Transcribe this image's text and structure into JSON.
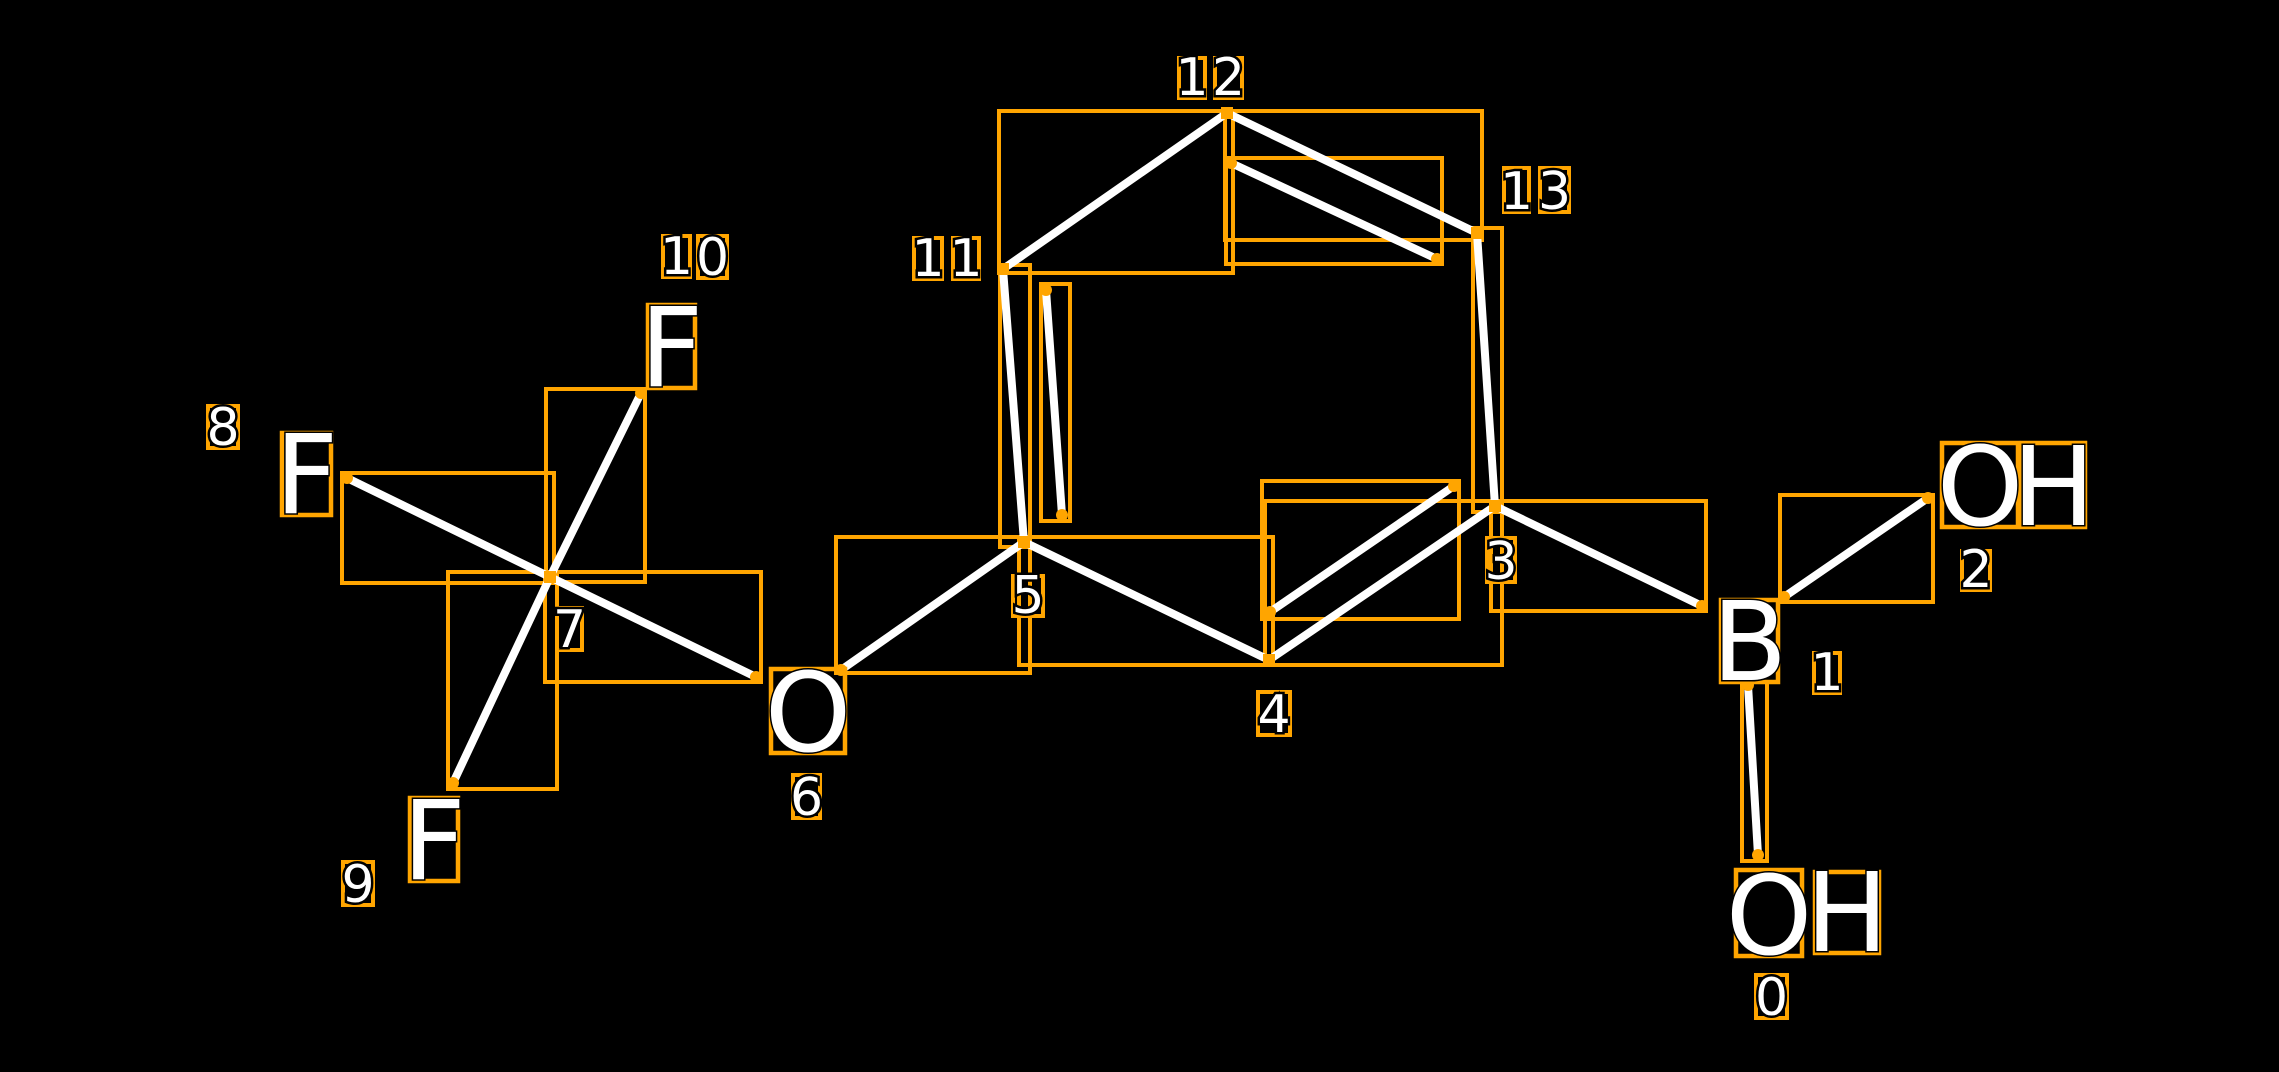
{
  "canvas": {
    "width": 2279,
    "height": 1072,
    "background": "#000000"
  },
  "colors": {
    "box_orange": "#FFA500",
    "bond_white": "#FFFFFF",
    "text_white": "#FFFFFF",
    "text_outline": "#000000"
  },
  "molecule": {
    "atoms": [
      {
        "index": 0,
        "symbol": "OH",
        "letters": [
          {
            "ch": "O",
            "x": 1736,
            "y": 870,
            "w": 66,
            "h": 86
          },
          {
            "ch": "H",
            "x": 1815,
            "y": 872,
            "w": 64,
            "h": 81
          }
        ]
      },
      {
        "index": 1,
        "symbol": "B",
        "letters": [
          {
            "ch": "B",
            "x": 1721,
            "y": 600,
            "w": 57,
            "h": 82
          }
        ]
      },
      {
        "index": 2,
        "symbol": "OH",
        "letters": [
          {
            "ch": "O",
            "x": 1942,
            "y": 443,
            "w": 76,
            "h": 84
          },
          {
            "ch": "H",
            "x": 2022,
            "y": 443,
            "w": 63,
            "h": 84
          }
        ]
      },
      {
        "index": 6,
        "symbol": "O",
        "letters": [
          {
            "ch": "O",
            "x": 771,
            "y": 669,
            "w": 74,
            "h": 84
          }
        ]
      },
      {
        "index": 8,
        "symbol": "F",
        "letters": [
          {
            "ch": "F",
            "x": 282,
            "y": 433,
            "w": 49,
            "h": 82
          }
        ]
      },
      {
        "index": 9,
        "symbol": "F",
        "letters": [
          {
            "ch": "F",
            "x": 410,
            "y": 798,
            "w": 48,
            "h": 83
          }
        ]
      },
      {
        "index": 10,
        "symbol": "F",
        "letters": [
          {
            "ch": "F",
            "x": 648,
            "y": 305,
            "w": 47,
            "h": 83
          }
        ]
      }
    ],
    "index_labels": [
      {
        "text": "0",
        "digits": [
          {
            "ch": "0",
            "x": 1756,
            "y": 975,
            "w": 31,
            "h": 43
          }
        ]
      },
      {
        "text": "1",
        "digits": [
          {
            "ch": "1",
            "x": 1814,
            "y": 653,
            "w": 26,
            "h": 40
          }
        ]
      },
      {
        "text": "2",
        "digits": [
          {
            "ch": "2",
            "x": 1962,
            "y": 551,
            "w": 28,
            "h": 39
          }
        ]
      },
      {
        "text": "3",
        "digits": [
          {
            "ch": "3",
            "x": 1487,
            "y": 538,
            "w": 28,
            "h": 44
          }
        ]
      },
      {
        "text": "4",
        "digits": [
          {
            "ch": "4",
            "x": 1258,
            "y": 692,
            "w": 32,
            "h": 43
          }
        ]
      },
      {
        "text": "5",
        "digits": [
          {
            "ch": "5",
            "x": 1013,
            "y": 576,
            "w": 30,
            "h": 40
          }
        ]
      },
      {
        "text": "6",
        "digits": [
          {
            "ch": "6",
            "x": 793,
            "y": 775,
            "w": 27,
            "h": 43
          }
        ]
      },
      {
        "text": "7",
        "digits": [
          {
            "ch": "7",
            "x": 557,
            "y": 608,
            "w": 25,
            "h": 42
          }
        ]
      },
      {
        "text": "8",
        "digits": [
          {
            "ch": "8",
            "x": 208,
            "y": 406,
            "w": 30,
            "h": 42
          }
        ]
      },
      {
        "text": "9",
        "digits": [
          {
            "ch": "9",
            "x": 343,
            "y": 862,
            "w": 30,
            "h": 43
          }
        ]
      },
      {
        "text": "10",
        "digits": [
          {
            "ch": "1",
            "x": 663,
            "y": 236,
            "w": 27,
            "h": 41
          },
          {
            "ch": "0",
            "x": 698,
            "y": 236,
            "w": 29,
            "h": 42
          }
        ]
      },
      {
        "text": "11",
        "digits": [
          {
            "ch": "1",
            "x": 914,
            "y": 238,
            "w": 28,
            "h": 41
          },
          {
            "ch": "1",
            "x": 953,
            "y": 238,
            "w": 26,
            "h": 41
          }
        ]
      },
      {
        "text": "12",
        "digits": [
          {
            "ch": "1",
            "x": 1179,
            "y": 58,
            "w": 26,
            "h": 40
          },
          {
            "ch": "2",
            "x": 1215,
            "y": 58,
            "w": 27,
            "h": 40
          }
        ]
      },
      {
        "text": "13",
        "digits": [
          {
            "ch": "1",
            "x": 1504,
            "y": 168,
            "w": 25,
            "h": 44
          },
          {
            "ch": "3",
            "x": 1540,
            "y": 168,
            "w": 29,
            "h": 44
          }
        ]
      }
    ],
    "bonds": [
      {
        "name": "C11-C12",
        "x1": 1003,
        "y1": 269,
        "x2": 1227,
        "y2": 113,
        "box": [
          999,
          111,
          234,
          162
        ]
      },
      {
        "name": "C12-C13",
        "x1": 1227,
        "y1": 113,
        "x2": 1477,
        "y2": 233,
        "box": [
          1225,
          111,
          257,
          129
        ]
      },
      {
        "name": "C12-C13-inner",
        "x1": 1231,
        "y1": 163,
        "x2": 1437,
        "y2": 259,
        "box": [
          1226,
          158,
          216,
          106
        ]
      },
      {
        "name": "C13-C3",
        "x1": 1477,
        "y1": 233,
        "x2": 1495,
        "y2": 506,
        "box": [
          1473,
          228,
          29,
          284
        ]
      },
      {
        "name": "C3-C4",
        "x1": 1495,
        "y1": 506,
        "x2": 1269,
        "y2": 660,
        "box": [
          1265,
          501,
          237,
          164
        ]
      },
      {
        "name": "C3-C4-inner",
        "x1": 1454,
        "y1": 486,
        "x2": 1270,
        "y2": 612,
        "box": [
          1262,
          481,
          197,
          138
        ]
      },
      {
        "name": "C4-C5",
        "x1": 1269,
        "y1": 660,
        "x2": 1024,
        "y2": 542,
        "box": [
          1019,
          537,
          254,
          128
        ]
      },
      {
        "name": "C5-C11",
        "x1": 1024,
        "y1": 542,
        "x2": 1003,
        "y2": 269,
        "box": [
          1000,
          265,
          30,
          282
        ]
      },
      {
        "name": "C5-C11-inner",
        "x1": 1046,
        "y1": 290,
        "x2": 1062,
        "y2": 515,
        "box": [
          1041,
          284,
          29,
          237
        ]
      },
      {
        "name": "C5-O6",
        "x1": 1024,
        "y1": 542,
        "x2": 841,
        "y2": 670,
        "box": [
          836,
          537,
          194,
          136
        ]
      },
      {
        "name": "O6-C7",
        "x1": 756,
        "y1": 677,
        "x2": 550,
        "y2": 577,
        "box": [
          545,
          572,
          216,
          110
        ]
      },
      {
        "name": "C7-F8",
        "x1": 550,
        "y1": 577,
        "x2": 347,
        "y2": 478,
        "box": [
          342,
          473,
          212,
          110
        ]
      },
      {
        "name": "C7-F10",
        "x1": 550,
        "y1": 577,
        "x2": 641,
        "y2": 393,
        "box": [
          546,
          389,
          99,
          193
        ]
      },
      {
        "name": "C7-F9",
        "x1": 550,
        "y1": 577,
        "x2": 453,
        "y2": 783,
        "box": [
          448,
          572,
          109,
          217
        ]
      },
      {
        "name": "C3-B1",
        "x1": 1495,
        "y1": 506,
        "x2": 1702,
        "y2": 606,
        "box": [
          1491,
          501,
          215,
          110
        ]
      },
      {
        "name": "B1-OH2",
        "x1": 1784,
        "y1": 597,
        "x2": 1928,
        "y2": 498,
        "box": [
          1780,
          495,
          153,
          107
        ]
      },
      {
        "name": "B1-OH0",
        "x1": 1748,
        "y1": 685,
        "x2": 1758,
        "y2": 855,
        "box": [
          1742,
          682,
          25,
          179
        ]
      }
    ],
    "vertex_markers": [
      {
        "name": "vertex-12",
        "x": 1227,
        "y": 113
      },
      {
        "name": "vertex-11",
        "x": 1003,
        "y": 269
      },
      {
        "name": "vertex-13",
        "x": 1477,
        "y": 233
      },
      {
        "name": "vertex-5",
        "x": 1024,
        "y": 542
      },
      {
        "name": "vertex-4",
        "x": 1269,
        "y": 660
      },
      {
        "name": "vertex-3",
        "x": 1495,
        "y": 506
      },
      {
        "name": "vertex-7",
        "x": 550,
        "y": 577
      }
    ],
    "endpoint_dots": [
      {
        "x": 841,
        "y": 670
      },
      {
        "x": 756,
        "y": 677
      },
      {
        "x": 347,
        "y": 478
      },
      {
        "x": 641,
        "y": 393
      },
      {
        "x": 453,
        "y": 783
      },
      {
        "x": 1702,
        "y": 606
      },
      {
        "x": 1784,
        "y": 597
      },
      {
        "x": 1928,
        "y": 498
      },
      {
        "x": 1748,
        "y": 685
      },
      {
        "x": 1758,
        "y": 855
      },
      {
        "x": 1231,
        "y": 163
      },
      {
        "x": 1437,
        "y": 259
      },
      {
        "x": 1454,
        "y": 486
      },
      {
        "x": 1270,
        "y": 612
      },
      {
        "x": 1046,
        "y": 290
      },
      {
        "x": 1062,
        "y": 515
      }
    ]
  }
}
